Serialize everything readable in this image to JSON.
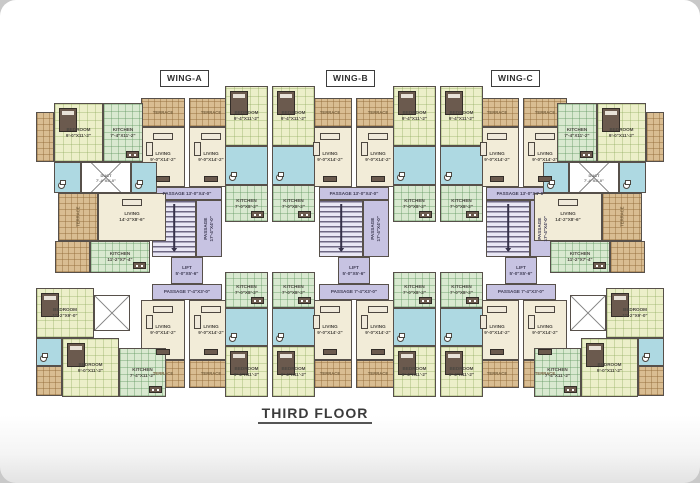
{
  "page": {
    "floor_title": "THIRD FLOOR"
  },
  "wing_labels": [
    {
      "label": "WING-A",
      "x": 160
    },
    {
      "label": "WING-B",
      "x": 326
    },
    {
      "label": "WING-C",
      "x": 491
    }
  ],
  "colors": {
    "wall": "#57504a",
    "terrace": "#d9bd92",
    "living": "#f2ecd8",
    "bedroom": "#ecefc9",
    "kitchen": "#d9e9d0",
    "bath": "#aed9e2",
    "core": "#c7c3e2",
    "furn": "#6b5a4e"
  },
  "room_types": {
    "t": "terrace",
    "l": "living-room",
    "b": "bedroom",
    "k": "kitchen",
    "w": "bathroom",
    "c": "passage",
    "s": "staircase",
    "f": "lift",
    "d": "duct"
  },
  "plan": {
    "rooms": [
      {
        "t": "t",
        "x": 141,
        "y": 98,
        "w": 44,
        "h": 29,
        "l": "TERRACE"
      },
      {
        "t": "t",
        "x": 189,
        "y": 98,
        "w": 44,
        "h": 29,
        "l": "TERRACE"
      },
      {
        "t": "l",
        "x": 141,
        "y": 127,
        "w": 44,
        "h": 60,
        "l": "LIVING\n9'-0\"X14'-2\""
      },
      {
        "t": "l",
        "x": 189,
        "y": 127,
        "w": 44,
        "h": 60,
        "l": "LIVING\n9'-0\"X14'-2\""
      },
      {
        "t": "c",
        "x": 152,
        "y": 187,
        "w": 70,
        "h": 13,
        "l": "PASSAGE 13'-0\"X4'-0\""
      },
      {
        "t": "s",
        "x": 152,
        "y": 200,
        "w": 44,
        "h": 57
      },
      {
        "t": "c",
        "x": 196,
        "y": 200,
        "w": 26,
        "h": 57,
        "l": "PASSAGE\n17'-4\"X4'-0\"",
        "r": 1
      },
      {
        "t": "f",
        "x": 171,
        "y": 257,
        "w": 32,
        "h": 27,
        "l": "LIFT\n5'-0\"X5'-6\""
      },
      {
        "t": "c",
        "x": 152,
        "y": 284,
        "w": 70,
        "h": 16,
        "l": "PASSAGE 7'-4\"X3'-0\""
      },
      {
        "t": "l",
        "x": 141,
        "y": 300,
        "w": 44,
        "h": 60,
        "l": "LIVING\n9'-0\"X14'-2\""
      },
      {
        "t": "l",
        "x": 189,
        "y": 300,
        "w": 44,
        "h": 60,
        "l": "LIVING\n9'-0\"X14'-2\""
      },
      {
        "t": "t",
        "x": 141,
        "y": 360,
        "w": 44,
        "h": 28,
        "l": "TERRACE"
      },
      {
        "t": "t",
        "x": 189,
        "y": 360,
        "w": 44,
        "h": 28,
        "l": "TERRACE"
      },
      {
        "t": "t",
        "x": 308,
        "y": 98,
        "w": 44,
        "h": 29,
        "l": "TERRACE"
      },
      {
        "t": "t",
        "x": 356,
        "y": 98,
        "w": 44,
        "h": 29,
        "l": "TERRACE"
      },
      {
        "t": "l",
        "x": 308,
        "y": 127,
        "w": 44,
        "h": 60,
        "l": "LIVING\n9'-0\"X14'-2\""
      },
      {
        "t": "l",
        "x": 356,
        "y": 127,
        "w": 44,
        "h": 60,
        "l": "LIVING\n9'-0\"X14'-2\""
      },
      {
        "t": "c",
        "x": 319,
        "y": 187,
        "w": 70,
        "h": 13,
        "l": "PASSAGE 13'-0\"X4'-0\""
      },
      {
        "t": "s",
        "x": 319,
        "y": 200,
        "w": 44,
        "h": 57
      },
      {
        "t": "c",
        "x": 363,
        "y": 200,
        "w": 26,
        "h": 57,
        "l": "PASSAGE\n17'-4\"X4'-0\"",
        "r": 1
      },
      {
        "t": "f",
        "x": 338,
        "y": 257,
        "w": 32,
        "h": 27,
        "l": "LIFT\n5'-0\"X5'-6\""
      },
      {
        "t": "c",
        "x": 319,
        "y": 284,
        "w": 70,
        "h": 16,
        "l": "PASSAGE 7'-4\"X3'-0\""
      },
      {
        "t": "l",
        "x": 308,
        "y": 300,
        "w": 44,
        "h": 60,
        "l": "LIVING\n9'-0\"X14'-2\""
      },
      {
        "t": "l",
        "x": 356,
        "y": 300,
        "w": 44,
        "h": 60,
        "l": "LIVING\n9'-0\"X14'-2\""
      },
      {
        "t": "t",
        "x": 308,
        "y": 360,
        "w": 44,
        "h": 28,
        "l": "TERRACE"
      },
      {
        "t": "t",
        "x": 356,
        "y": 360,
        "w": 44,
        "h": 28,
        "l": "TERRACE"
      },
      {
        "t": "t",
        "x": 475,
        "y": 98,
        "w": 44,
        "h": 29,
        "l": "TERRACE"
      },
      {
        "t": "t",
        "x": 523,
        "y": 98,
        "w": 44,
        "h": 29,
        "l": "TERRACE"
      },
      {
        "t": "l",
        "x": 475,
        "y": 127,
        "w": 44,
        "h": 60,
        "l": "LIVING\n9'-0\"X14'-2\""
      },
      {
        "t": "l",
        "x": 523,
        "y": 127,
        "w": 44,
        "h": 60,
        "l": "LIVING\n9'-0\"X14'-2\""
      },
      {
        "t": "c",
        "x": 486,
        "y": 187,
        "w": 70,
        "h": 13,
        "l": "PASSAGE 13'-0\"X4'-0\""
      },
      {
        "t": "s",
        "x": 486,
        "y": 200,
        "w": 44,
        "h": 57
      },
      {
        "t": "c",
        "x": 530,
        "y": 200,
        "w": 26,
        "h": 57,
        "l": "PASSAGE\n17'-4\"X4'-0\"",
        "r": 1
      },
      {
        "t": "f",
        "x": 505,
        "y": 257,
        "w": 32,
        "h": 27,
        "l": "LIFT\n5'-0\"X5'-6\""
      },
      {
        "t": "c",
        "x": 486,
        "y": 284,
        "w": 70,
        "h": 16,
        "l": "PASSAGE 7'-4\"X3'-0\""
      },
      {
        "t": "l",
        "x": 475,
        "y": 300,
        "w": 44,
        "h": 60,
        "l": "LIVING\n9'-0\"X14'-2\""
      },
      {
        "t": "l",
        "x": 523,
        "y": 300,
        "w": 44,
        "h": 60,
        "l": "LIVING\n9'-0\"X14'-2\""
      },
      {
        "t": "t",
        "x": 475,
        "y": 360,
        "w": 44,
        "h": 28,
        "l": "TERRACE"
      },
      {
        "t": "t",
        "x": 523,
        "y": 360,
        "w": 44,
        "h": 28,
        "l": "TERRACE"
      },
      {
        "t": "b",
        "x": 225,
        "y": 86,
        "w": 43,
        "h": 60,
        "l": "BEDROOM\n9'-4\"X11'-2\""
      },
      {
        "t": "b",
        "x": 272,
        "y": 86,
        "w": 43,
        "h": 60,
        "l": "BEDROOM\n9'-4\"X11'-2\""
      },
      {
        "t": "w",
        "x": 225,
        "y": 146,
        "w": 43,
        "h": 39
      },
      {
        "t": "w",
        "x": 272,
        "y": 146,
        "w": 43,
        "h": 39
      },
      {
        "t": "k",
        "x": 225,
        "y": 185,
        "w": 43,
        "h": 37,
        "l": "KITCHEN\n7'-0\"X8'-2\""
      },
      {
        "t": "k",
        "x": 272,
        "y": 185,
        "w": 43,
        "h": 37,
        "l": "KITCHEN\n7'-0\"X8'-2\""
      },
      {
        "t": "k",
        "x": 225,
        "y": 272,
        "w": 43,
        "h": 36,
        "l": "KITCHEN\n7'-0\"X8'-2\""
      },
      {
        "t": "k",
        "x": 272,
        "y": 272,
        "w": 43,
        "h": 36,
        "l": "KITCHEN\n7'-0\"X8'-2\""
      },
      {
        "t": "w",
        "x": 225,
        "y": 308,
        "w": 43,
        "h": 38
      },
      {
        "t": "w",
        "x": 272,
        "y": 308,
        "w": 43,
        "h": 38
      },
      {
        "t": "b",
        "x": 225,
        "y": 346,
        "w": 43,
        "h": 51,
        "l": "BEDROOM\n9'-4\"X11'-2\""
      },
      {
        "t": "b",
        "x": 272,
        "y": 346,
        "w": 43,
        "h": 51,
        "l": "BEDROOM\n9'-4\"X11'-2\""
      },
      {
        "t": "b",
        "x": 393,
        "y": 86,
        "w": 43,
        "h": 60,
        "l": "BEDROOM\n9'-4\"X11'-2\""
      },
      {
        "t": "b",
        "x": 440,
        "y": 86,
        "w": 43,
        "h": 60,
        "l": "BEDROOM\n9'-4\"X11'-2\""
      },
      {
        "t": "w",
        "x": 393,
        "y": 146,
        "w": 43,
        "h": 39
      },
      {
        "t": "w",
        "x": 440,
        "y": 146,
        "w": 43,
        "h": 39
      },
      {
        "t": "k",
        "x": 393,
        "y": 185,
        "w": 43,
        "h": 37,
        "l": "KITCHEN\n7'-0\"X8'-2\""
      },
      {
        "t": "k",
        "x": 440,
        "y": 185,
        "w": 43,
        "h": 37,
        "l": "KITCHEN\n7'-0\"X8'-2\""
      },
      {
        "t": "k",
        "x": 393,
        "y": 272,
        "w": 43,
        "h": 36,
        "l": "KITCHEN\n7'-0\"X8'-2\""
      },
      {
        "t": "k",
        "x": 440,
        "y": 272,
        "w": 43,
        "h": 36,
        "l": "KITCHEN\n7'-0\"X8'-2\""
      },
      {
        "t": "w",
        "x": 393,
        "y": 308,
        "w": 43,
        "h": 38
      },
      {
        "t": "w",
        "x": 440,
        "y": 308,
        "w": 43,
        "h": 38
      },
      {
        "t": "b",
        "x": 393,
        "y": 346,
        "w": 43,
        "h": 51,
        "l": "BEDROOM\n9'-4\"X11'-2\""
      },
      {
        "t": "b",
        "x": 440,
        "y": 346,
        "w": 43,
        "h": 51,
        "l": "BEDROOM\n9'-4\"X11'-2\""
      },
      {
        "t": "t",
        "x": 36,
        "y": 112,
        "w": 18,
        "h": 50
      },
      {
        "t": "b",
        "x": 54,
        "y": 103,
        "w": 49,
        "h": 59,
        "l": "BEDROOM\n9'-0\"X11'-2\""
      },
      {
        "t": "k",
        "x": 103,
        "y": 103,
        "w": 40,
        "h": 59,
        "l": "KITCHEN\n7'-4\"X11'-2\""
      },
      {
        "t": "w",
        "x": 54,
        "y": 162,
        "w": 27,
        "h": 31
      },
      {
        "t": "d",
        "x": 81,
        "y": 162,
        "w": 50,
        "h": 31,
        "l": "DUCT\n7'-4\"X5'-0\""
      },
      {
        "t": "w",
        "x": 131,
        "y": 162,
        "w": 26,
        "h": 31
      },
      {
        "t": "t",
        "x": 58,
        "y": 193,
        "w": 40,
        "h": 48,
        "l": "TERRACE",
        "r": 1
      },
      {
        "t": "l",
        "x": 98,
        "y": 193,
        "w": 68,
        "h": 48,
        "l": "LIVING\n14'-2\"X8'-6\""
      },
      {
        "t": "t",
        "x": 55,
        "y": 241,
        "w": 35,
        "h": 32
      },
      {
        "t": "k",
        "x": 90,
        "y": 241,
        "w": 60,
        "h": 32,
        "l": "KITCHEN\n11'-2\"X7'-4\""
      },
      {
        "t": "b",
        "x": 36,
        "y": 288,
        "w": 58,
        "h": 50,
        "l": "BEDROOM\n11'-2\"X9'-0\""
      },
      {
        "t": "d",
        "x": 94,
        "y": 295,
        "w": 36,
        "h": 36
      },
      {
        "t": "w",
        "x": 36,
        "y": 338,
        "w": 26,
        "h": 28
      },
      {
        "t": "b",
        "x": 62,
        "y": 338,
        "w": 57,
        "h": 59,
        "l": "BEDROOM\n9'-0\"X11'-2\""
      },
      {
        "t": "k",
        "x": 119,
        "y": 348,
        "w": 47,
        "h": 49,
        "l": "KITCHEN\n7'-4\"X11'-2\""
      },
      {
        "t": "t",
        "x": 36,
        "y": 366,
        "w": 26,
        "h": 30
      },
      {
        "t": "t",
        "x": 646,
        "y": 112,
        "w": 18,
        "h": 50
      },
      {
        "t": "b",
        "x": 597,
        "y": 103,
        "w": 49,
        "h": 59,
        "l": "BEDROOM\n9'-0\"X11'-2\""
      },
      {
        "t": "k",
        "x": 557,
        "y": 103,
        "w": 40,
        "h": 59,
        "l": "KITCHEN\n7'-4\"X11'-2\""
      },
      {
        "t": "w",
        "x": 619,
        "y": 162,
        "w": 27,
        "h": 31
      },
      {
        "t": "d",
        "x": 569,
        "y": 162,
        "w": 50,
        "h": 31,
        "l": "DUCT\n7'-4\"X5'-0\""
      },
      {
        "t": "w",
        "x": 543,
        "y": 162,
        "w": 26,
        "h": 31
      },
      {
        "t": "t",
        "x": 602,
        "y": 193,
        "w": 40,
        "h": 48,
        "l": "TERRACE",
        "r": 1
      },
      {
        "t": "l",
        "x": 534,
        "y": 193,
        "w": 68,
        "h": 48,
        "l": "LIVING\n14'-2\"X8'-6\""
      },
      {
        "t": "t",
        "x": 610,
        "y": 241,
        "w": 35,
        "h": 32
      },
      {
        "t": "k",
        "x": 550,
        "y": 241,
        "w": 60,
        "h": 32,
        "l": "KITCHEN\n11'-2\"X7'-4\""
      },
      {
        "t": "b",
        "x": 606,
        "y": 288,
        "w": 58,
        "h": 50,
        "l": "BEDROOM\n11'-2\"X9'-0\""
      },
      {
        "t": "d",
        "x": 570,
        "y": 295,
        "w": 36,
        "h": 36
      },
      {
        "t": "w",
        "x": 638,
        "y": 338,
        "w": 26,
        "h": 28
      },
      {
        "t": "b",
        "x": 581,
        "y": 338,
        "w": 57,
        "h": 59,
        "l": "BEDROOM\n9'-0\"X11'-2\""
      },
      {
        "t": "k",
        "x": 534,
        "y": 348,
        "w": 47,
        "h": 49,
        "l": "KITCHEN\n7'-4\"X11'-2\""
      },
      {
        "t": "t",
        "x": 638,
        "y": 366,
        "w": 26,
        "h": 30
      }
    ]
  }
}
